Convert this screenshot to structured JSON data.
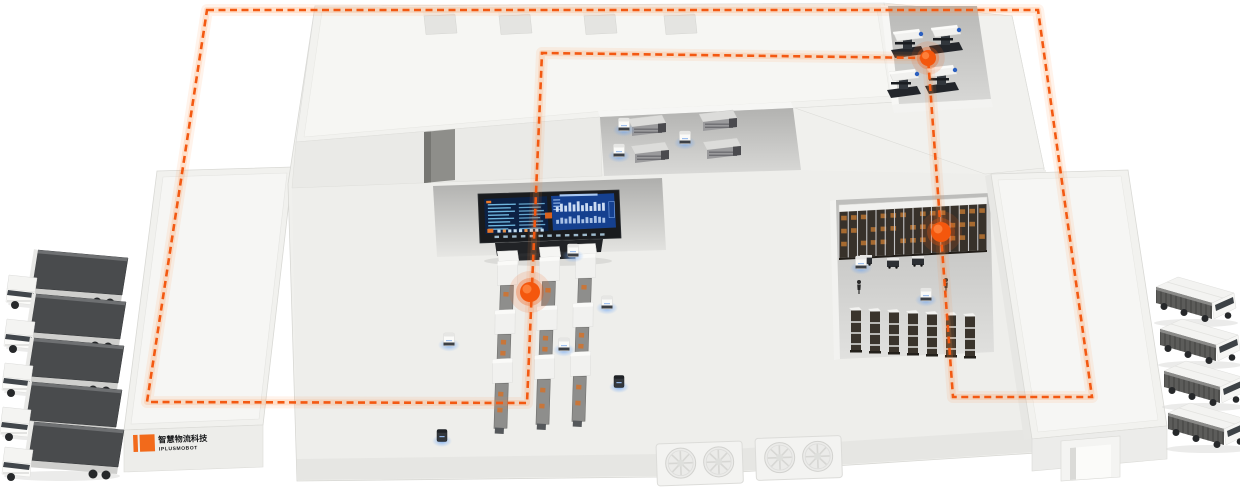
{
  "scene": {
    "width": 1240,
    "height": 488,
    "background": "#ffffff",
    "description": "Isometric smart-factory logistics illustration with dashed AGV route loop"
  },
  "brand": {
    "logo_cn": "智慧物流科技",
    "logo_en": "IPLUSMOBOT",
    "mark_color": "#f26a1b",
    "text_color": "#17181a"
  },
  "route": {
    "color": "#f35912",
    "glow": "#ff8a3c",
    "width": 2.6,
    "dash": "7 4.5",
    "loop": [
      [
        207,
        10
      ],
      [
        1038,
        10
      ],
      [
        1092,
        397
      ],
      [
        953,
        397
      ],
      [
        928,
        58
      ],
      [
        542,
        53
      ],
      [
        527,
        403
      ],
      [
        147,
        402
      ]
    ]
  },
  "waypoints": [
    {
      "x": 928,
      "y": 58,
      "r": 8
    },
    {
      "x": 941,
      "y": 232,
      "r": 10
    },
    {
      "x": 530,
      "y": 292,
      "r": 10
    }
  ],
  "roof_vents": {
    "y": 14,
    "xs": [
      424,
      499,
      584,
      664
    ]
  },
  "dashboard": {
    "left_rows": 8,
    "right_bars": 12,
    "chin_ticks": 13,
    "bottom_blocks": 9
  },
  "conveyors": [
    {
      "x": 508,
      "y": 256
    },
    {
      "x": 550,
      "y": 252
    },
    {
      "x": 586,
      "y": 249
    }
  ],
  "rack_top": {
    "x": 839,
    "y": 205,
    "length": 148,
    "drop": -8,
    "height": 46,
    "posts": 16,
    "box_rows": 3,
    "bays": 15
  },
  "rack_columns": [
    {
      "x": 849,
      "y": 308
    },
    {
      "x": 868,
      "y": 309
    },
    {
      "x": 887,
      "y": 310
    },
    {
      "x": 906,
      "y": 311
    },
    {
      "x": 925,
      "y": 312
    },
    {
      "x": 944,
      "y": 313
    },
    {
      "x": 963,
      "y": 314
    }
  ],
  "shuttles": [
    {
      "x": 866,
      "y": 260
    },
    {
      "x": 893,
      "y": 263
    },
    {
      "x": 918,
      "y": 261
    }
  ],
  "machines_top": [
    {
      "x": 908,
      "y": 42
    },
    {
      "x": 946,
      "y": 38
    },
    {
      "x": 904,
      "y": 82
    },
    {
      "x": 942,
      "y": 78
    }
  ],
  "machines_center": [
    {
      "x": 647,
      "y": 122
    },
    {
      "x": 718,
      "y": 117
    },
    {
      "x": 650,
      "y": 149
    },
    {
      "x": 722,
      "y": 145
    }
  ],
  "agvs": [
    {
      "x": 573,
      "y": 252
    },
    {
      "x": 607,
      "y": 304
    },
    {
      "x": 564,
      "y": 346
    },
    {
      "x": 449,
      "y": 341
    },
    {
      "x": 685,
      "y": 139
    },
    {
      "x": 624,
      "y": 126
    },
    {
      "x": 619,
      "y": 152
    },
    {
      "x": 926,
      "y": 296
    },
    {
      "x": 861,
      "y": 264
    },
    {
      "x": 619,
      "y": 383,
      "dark": true
    },
    {
      "x": 442,
      "y": 437,
      "dark": true
    }
  ],
  "workers": [
    {
      "x": 859,
      "y": 289
    },
    {
      "x": 946,
      "y": 287
    }
  ],
  "trucks_left": [
    {
      "x": 4,
      "y": 248
    },
    {
      "x": 2,
      "y": 292
    },
    {
      "x": 0,
      "y": 336
    },
    {
      "x": -2,
      "y": 380
    },
    {
      "x": 0,
      "y": 420
    }
  ],
  "trucks_right": [
    {
      "x": 1150,
      "y": 277
    },
    {
      "x": 1154,
      "y": 319
    },
    {
      "x": 1158,
      "y": 361
    },
    {
      "x": 1162,
      "y": 403
    }
  ]
}
